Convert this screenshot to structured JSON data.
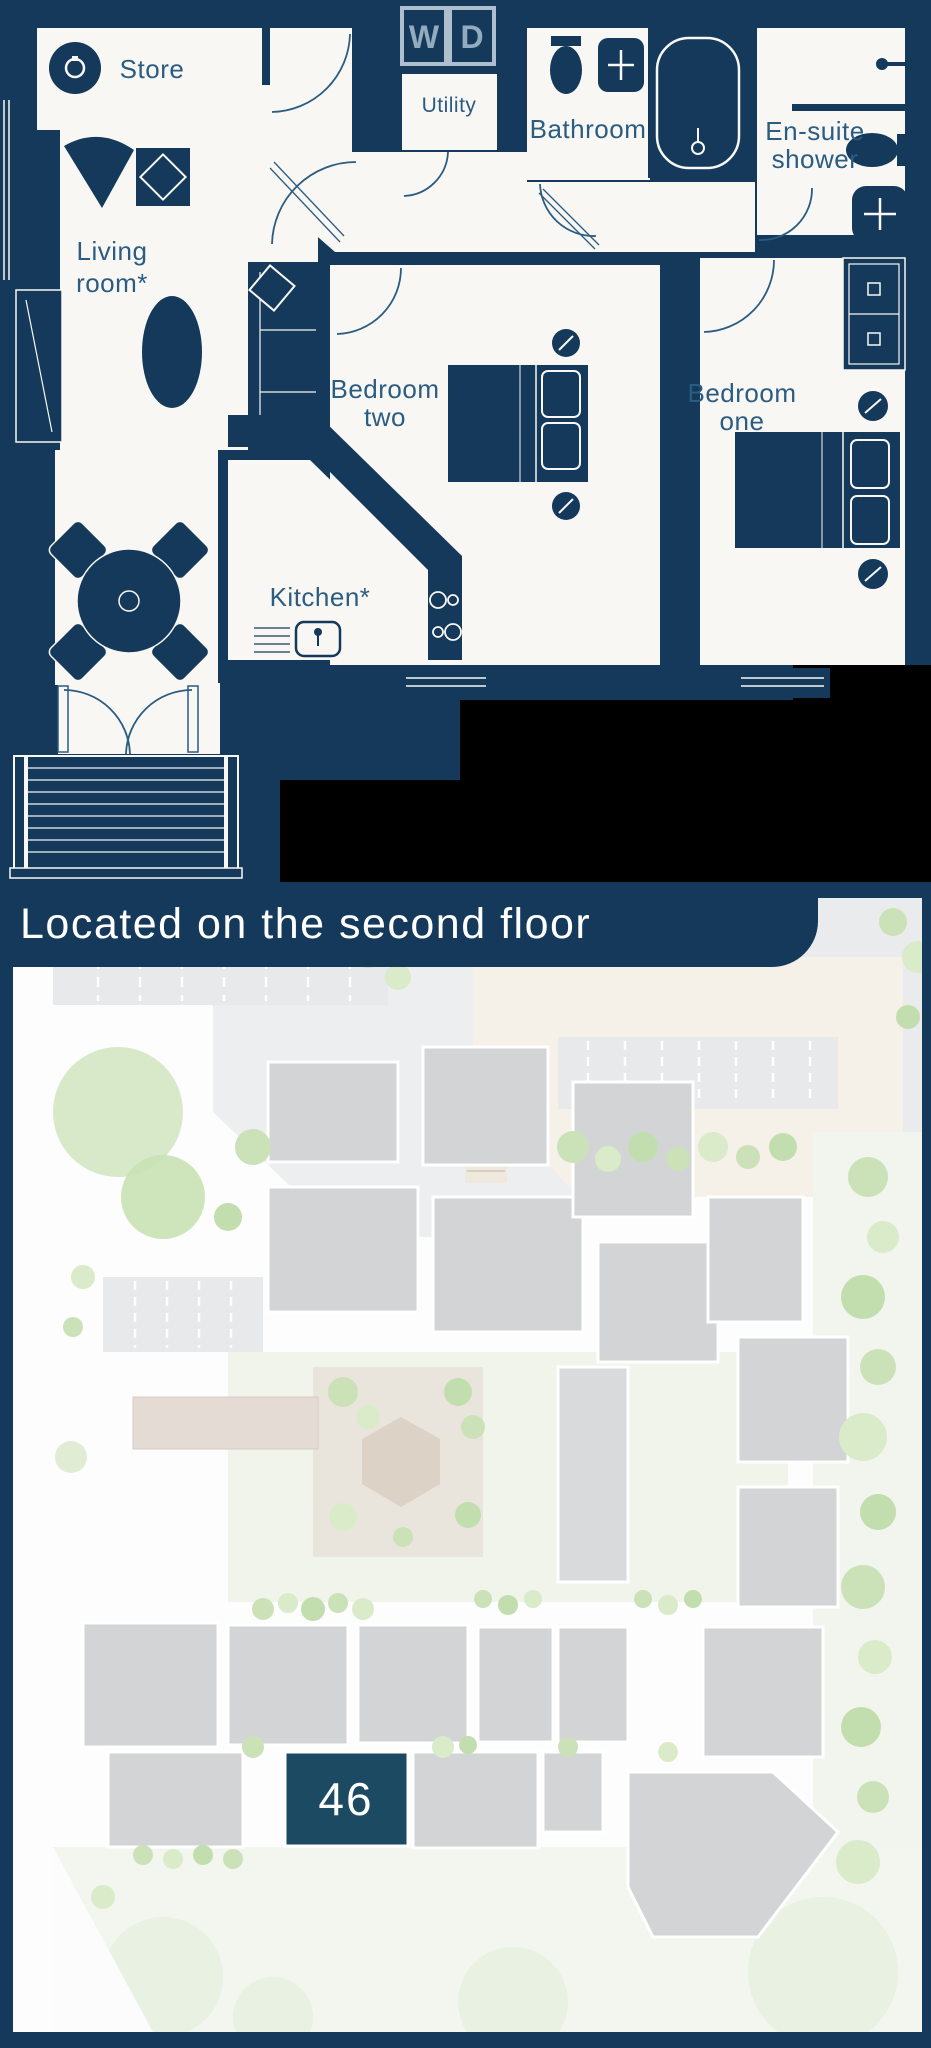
{
  "floorplan": {
    "rooms": {
      "store": {
        "label": "Store"
      },
      "utility": {
        "label": "Utility"
      },
      "bathroom": {
        "label": "Bathroom"
      },
      "ensuite": {
        "line1": "En-suite",
        "line2": "shower"
      },
      "living_room": {
        "line1": "Living",
        "line2": "room*"
      },
      "bedroom_two": {
        "line1": "Bedroom",
        "line2": "two"
      },
      "bedroom_one": {
        "line1": "Bedroom",
        "line2": "one"
      },
      "kitchen": {
        "label": "Kitchen*"
      }
    },
    "appliances": {
      "washer_label": "W",
      "dryer_label": "D"
    }
  },
  "location_banner": {
    "text": "Located on the second floor"
  },
  "site_map": {
    "highlighted_unit": "46"
  },
  "colors": {
    "navy": "#14395B",
    "room_fill": "#F8F7F3",
    "label_blue": "#2B5C82",
    "banner_text": "#FFFFFF",
    "unit_highlight": "#1D4A63",
    "building_gray": "#D2D4D6",
    "tree_green": "#CBE2B8",
    "plaza_beige": "#F5F0E8"
  }
}
